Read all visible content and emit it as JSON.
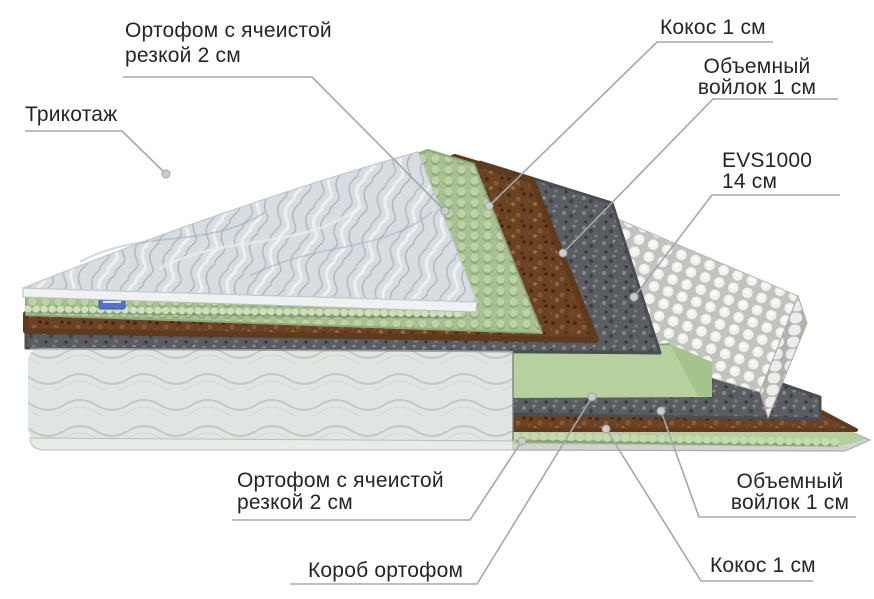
{
  "diagram": {
    "type": "mattress-layers-cutaway-infographic",
    "labels": {
      "trikotazh": {
        "line1": "Трикотаж"
      },
      "orthofoam_top": {
        "line1": "Ортофом с ячеистой",
        "line2": "резкой 2 см"
      },
      "coconut_top": {
        "line1": "Кокос 1 см"
      },
      "felt_top": {
        "line1": "Объемный",
        "line2": "войлок 1 см"
      },
      "springs": {
        "line1": "EVS1000",
        "line2": "14 см"
      },
      "orthofoam_bottom": {
        "line1": "Ортофом с ячеистой",
        "line2": "резкой 2 см"
      },
      "korob": {
        "line1": "Короб ортофом"
      },
      "felt_bottom": {
        "line1": "Объемный",
        "line2": "войлок 1 см"
      },
      "coconut_bottom": {
        "line1": "Кокос 1 см"
      }
    },
    "layers": [
      {
        "name": "Трикотаж",
        "color": "#d8dde1"
      },
      {
        "name": "Ортофом с ячеистой резкой 2 см",
        "color": "#a9c190"
      },
      {
        "name": "Кокос 1 см",
        "color": "#6f4527"
      },
      {
        "name": "Объемный войлок 1 см",
        "color": "#5a5e62"
      },
      {
        "name": "EVS1000 14 см",
        "color": "#ededeb"
      },
      {
        "name": "Объемный войлок 1 см",
        "color": "#5a5e62"
      },
      {
        "name": "Кокос 1 см",
        "color": "#6b4224"
      },
      {
        "name": "Ортофом с ячеистой резкой 2 см",
        "color": "#b5cd9f"
      },
      {
        "name": "Короб ортофом",
        "color": "#b6d19e"
      }
    ],
    "colors": {
      "background": "#ffffff",
      "text": "#22262a",
      "leader_line": "#a3a8a8",
      "body_fabric": "#e2e6e2",
      "brand_tag": "#5470cf",
      "base_tray": "#ced4ce"
    }
  }
}
